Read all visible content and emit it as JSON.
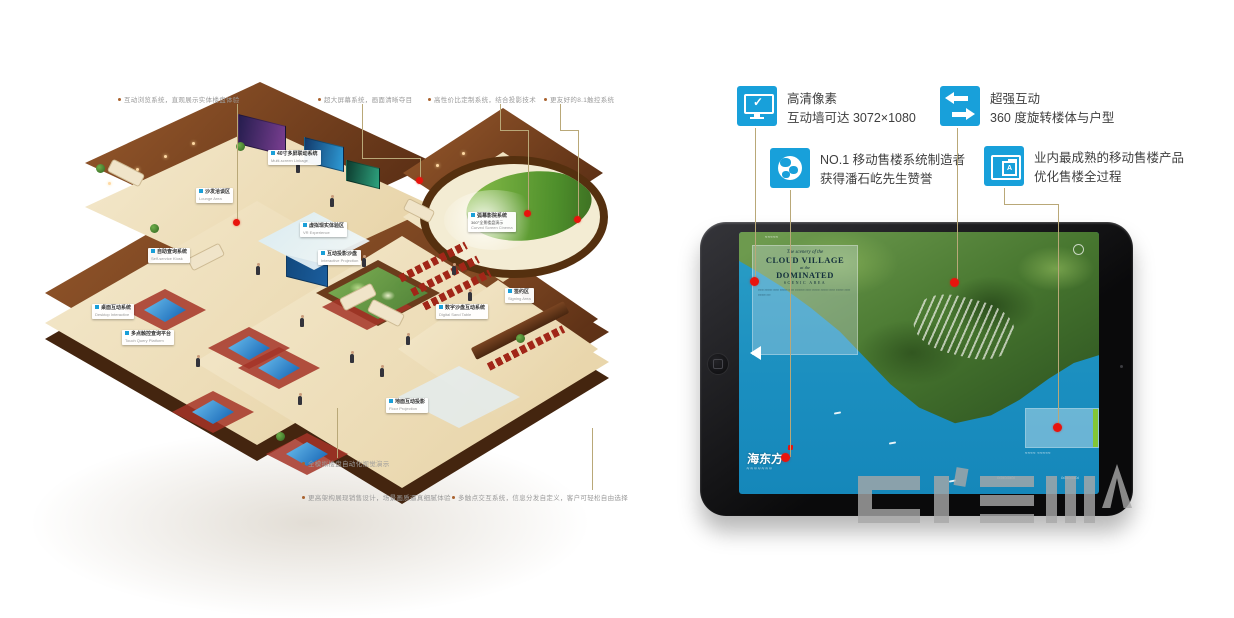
{
  "left": {
    "top_labels": [
      {
        "text": "互动浏览系统，直观展示实体楼盘体验"
      },
      {
        "text": "超大屏幕系统，画面清晰夺目"
      },
      {
        "text": "高性价比定制系统，结合投影技术"
      },
      {
        "text": "更友好的8.1触控系统"
      }
    ],
    "bottom_labels": [
      {
        "text": "全模拟楼盘自动化视觉演示"
      },
      {
        "text": "更高架构展现销售设计，场景画质逼真细腻体验"
      },
      {
        "text": "多触点交互系统，信息分发自定义，客户可轻松自由选择"
      }
    ],
    "scene_labels": [
      {
        "zh": "40寸多屏联动系统",
        "en": "Multi-screen Linkage"
      },
      {
        "zh": "沙发洽谈区",
        "en": "Lounge Area"
      },
      {
        "zh": "虚拟现实体验区",
        "en": "VR Experience"
      },
      {
        "zh": "互动投影沙盘",
        "en": "Interactive Projection"
      },
      {
        "zh": "自助查询系统",
        "en": "Self-service Kiosk"
      },
      {
        "zh": "桌面互动系统",
        "en": "Desktop Interactive"
      },
      {
        "zh": "多点触控查询平台",
        "en": "Touch Query Platform"
      },
      {
        "zh": "数字沙盘互动系统",
        "en": "Digital Sand Table"
      },
      {
        "zh": "弧幕影院系统",
        "ex": "360°全景楼盘演示",
        "en": "Curved Screen Cinema"
      },
      {
        "zh": "签约区",
        "en": "Signing Area"
      },
      {
        "zh": "地面互动投影",
        "en": "Floor Projection"
      }
    ]
  },
  "right": {
    "features": [
      {
        "line1": "高清像素",
        "line2": "互动墙可达 3072×1080"
      },
      {
        "line1": "超强互动",
        "line2": "360 度旋转楼体与户型"
      },
      {
        "line1": "NO.1 移动售楼系统制造者",
        "line2": "获得潘石屹先生赞誉"
      },
      {
        "line1": "业内最成熟的移动售楼产品",
        "line2": "优化售楼全过程"
      }
    ],
    "icon_a_letter": "A",
    "tablet": {
      "overlay": {
        "tagline": "The scenery of the",
        "title1": "CLOUD VILLAGE",
        "mid": "at the",
        "title2": "DOMINATED",
        "subtitle": "SCENIC AREA",
        "body": "≈≈≈ ≈≈≈≈ ≈≈≈ ≈≈≈≈ ≈≈≈ ≈≈≈≈≈ ≈≈≈ ≈≈≈≈ ≈≈≈≈ ≈≈≈ ≈≈≈≈ ≈≈≈ ≈≈≈≈ ≈≈"
      },
      "top_caption": "≈≈≈≈≈",
      "logo_zh": "海东方",
      "logo_script": "≈≈≈≈≈≈≈",
      "panel_caption": "≈≈≈≈ ≈≈≈≈≈",
      "script_word1": "≈≈≈≈≈",
      "script_word2": "≈≈≈≈≈"
    }
  }
}
